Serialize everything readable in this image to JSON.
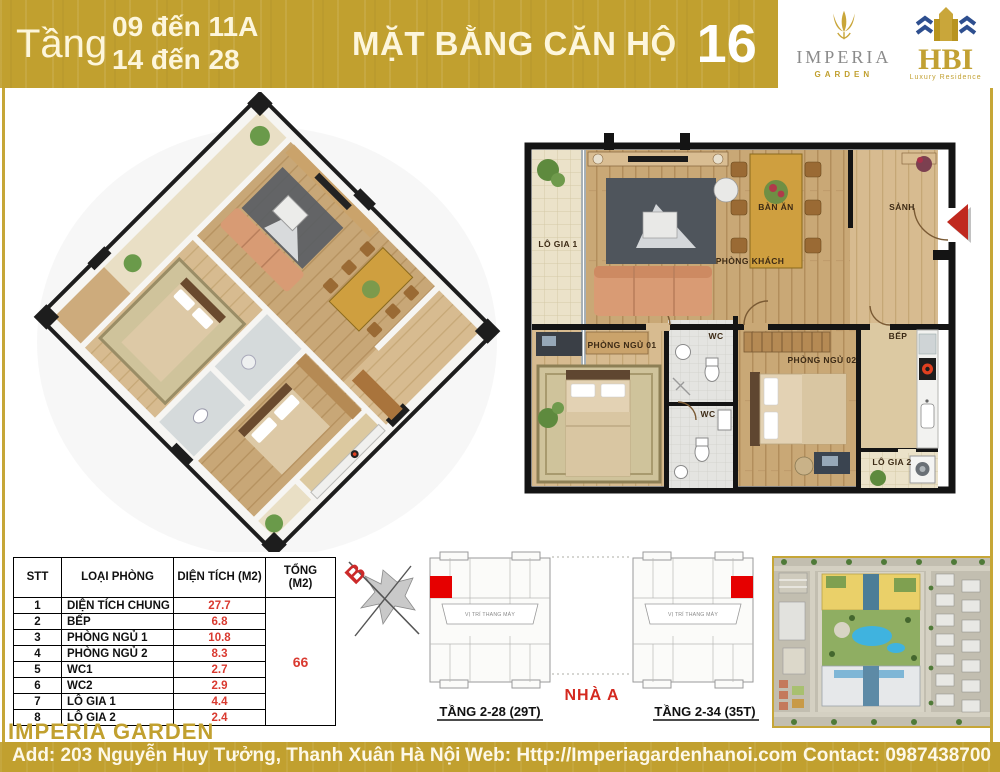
{
  "header": {
    "floor_word": "Tầng",
    "floor_line1": "09 đến 11A",
    "floor_line2": "14 đến 28",
    "title": "MẶT BẰNG CĂN HỘ",
    "unit_number": "16"
  },
  "logos": {
    "imperia": {
      "name": "IMPERIA",
      "sub": "GARDEN"
    },
    "hbi": {
      "name": "HBI",
      "sub": "Luxury Residence"
    }
  },
  "icons": {
    "imperia_tulip": "gold-tulip-shape",
    "hbi_buildings": "gold-tower-blue-roofs",
    "entrance_arrow": "◀",
    "compass": "crossed-arrows-star"
  },
  "plan2d": {
    "labels": {
      "lo_gia_1": "LÔ GIA 1",
      "ban_an": "BÀN ĂN",
      "phong_khach": "PHÒNG KHÁCH",
      "sanh": "SẢNH",
      "phong_ngu_01": "PHÒNG NGỦ 01",
      "wc_top": "WC",
      "wc_bottom": "WC",
      "phong_ngu_02": "PHÒNG NGỦ 02",
      "bep": "BẾP",
      "lo_gia_2": "LÔ GIA 2"
    }
  },
  "area_table": {
    "col_stt": "STT",
    "col_room": "LOẠI PHÒNG",
    "col_area": "DIỆN TÍCH (M2)",
    "col_total_1": "TỔNG",
    "col_total_2": "(M2)",
    "rows": [
      {
        "stt": "1",
        "room": "DIỆN TÍCH CHUNG",
        "area": "27.7"
      },
      {
        "stt": "2",
        "room": "BẾP",
        "area": "6.8"
      },
      {
        "stt": "3",
        "room": "PHÒNG NGỦ 1",
        "area": "10.8"
      },
      {
        "stt": "4",
        "room": "PHÒNG NGỦ 2",
        "area": "8.3"
      },
      {
        "stt": "5",
        "room": "WC1",
        "area": "2.7"
      },
      {
        "stt": "6",
        "room": "WC2",
        "area": "2.9"
      },
      {
        "stt": "7",
        "room": "LÔ GIA 1",
        "area": "4.4"
      },
      {
        "stt": "8",
        "room": "LÔ GIA 2",
        "area": "2.4"
      }
    ],
    "total": "66"
  },
  "key_plans": {
    "compass_label": "B",
    "elevator_text": "VỊ TRÍ THANG MÁY",
    "left_caption": "TẦNG 2-28 (29T)",
    "building_label": "NHÀ A",
    "right_caption": "TẦNG 2-34 (35T)"
  },
  "footer": {
    "brand": "IMPERIA GARDEN",
    "address": "Add: 203 Nguyễn Huy Tưởng, Thanh Xuân Hà Nội",
    "web": "Web: Http://Imperiagardenhanoi.com",
    "contact": "Contact: 0987438700"
  },
  "colors": {
    "gold": "#c1a02f",
    "cream_text": "#fdf6dc",
    "value_red": "#d93a30",
    "unit_highlight_red": "#e60000"
  }
}
